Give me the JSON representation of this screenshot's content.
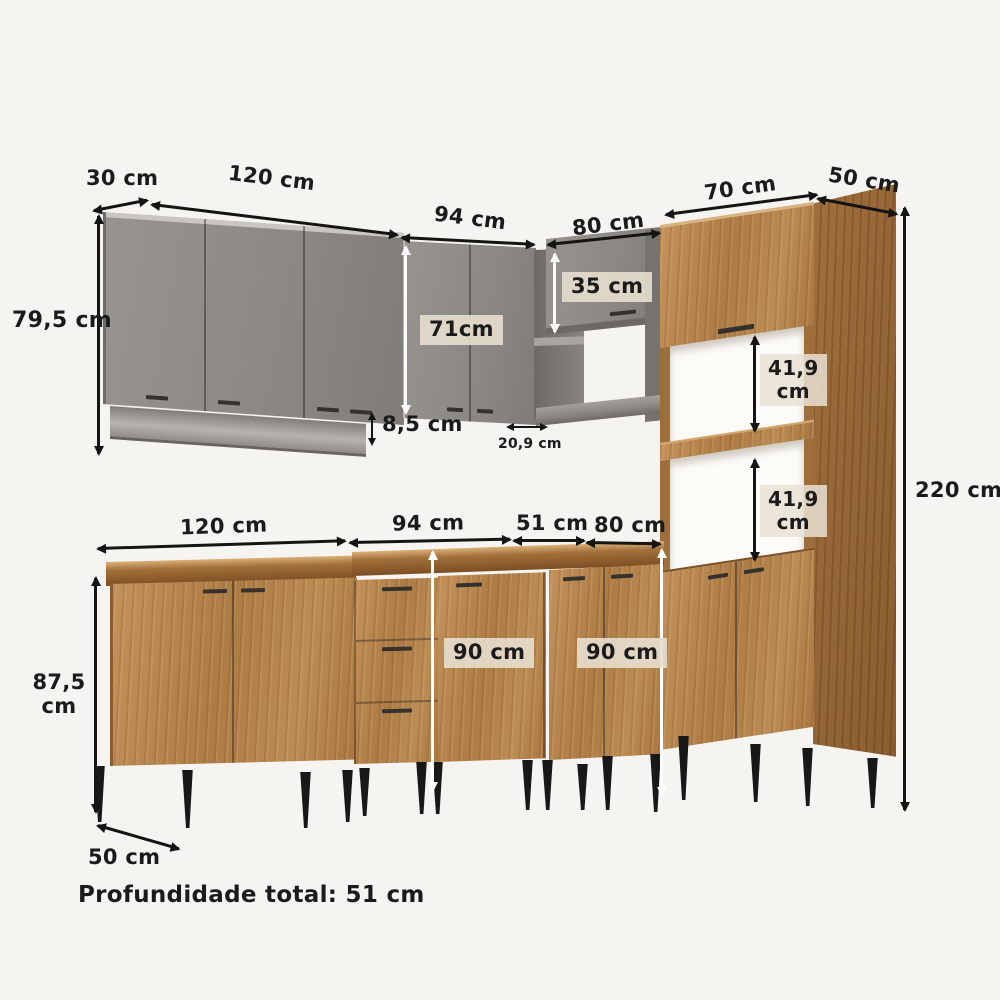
{
  "diagram": {
    "kind": "kitchen-cabinet-dimension-diagram",
    "footer": {
      "text": "Profundidade total: 51 cm"
    },
    "colors": {
      "background": "#f6f4f1",
      "cabinet_gray": "#8c8985",
      "cabinet_wood": "#ad7b44",
      "countertop_wood": "#7c4e24",
      "leg_black": "#191817",
      "arrow_black": "#141414",
      "arrow_white": "#ffffff",
      "label_chip": "#e7ded0",
      "label_text": "#1b1b1b"
    },
    "dims": {
      "upper_depth": "30 cm",
      "upper_left_width": "120 cm",
      "upper_left_height": "79,5 cm",
      "upper_mid_width": "94 cm",
      "upper_mid_height": "71cm",
      "under_cabinet_height": "8,5 cm",
      "corner_shelf_depth": "20,9 cm",
      "upper_right_width": "80 cm",
      "upper_right_height": "35 cm",
      "tall_cabinet_width": "70 cm",
      "tall_cabinet_depth": "50 cm",
      "total_height": "220 cm",
      "niche_top": {
        "value": "41,9",
        "unit": "cm"
      },
      "niche_bottom": {
        "value": "41,9",
        "unit": "cm"
      },
      "base_left_width": "120 cm",
      "base_mid_width": "94 cm",
      "base_corner_width": "51 cm",
      "base_right_width": "80 cm",
      "base_left_height": {
        "value": "87,5",
        "unit": "cm"
      },
      "base_height_mid": "90 cm",
      "base_height_right": "90 cm",
      "base_depth": "50 cm"
    }
  }
}
